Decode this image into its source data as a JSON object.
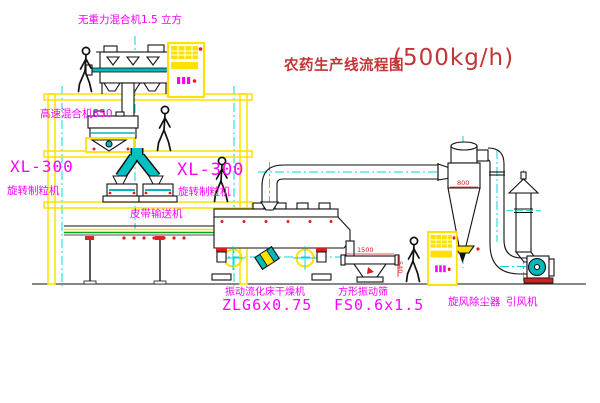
{
  "title": {
    "text": "农药生产线流程图",
    "capacity": "(500kg/h)"
  },
  "labels": {
    "gravity_mixer": "无重力混合机1.5 立方",
    "high_speed_mixer": "高速混合机350",
    "granulator_left_model": "XL-300",
    "granulator_left_name": "旋转制粒机",
    "granulator_right_model": "XL-300",
    "granulator_right_name": "旋转制粒机",
    "belt_conveyor": "皮带输送机",
    "dryer_name": "振动流化床干燥机",
    "dryer_model": "ZLG6x0.75",
    "sieve_name": "方形振动筛",
    "sieve_model": "FS0.6x1.5",
    "cyclone": "旋风除尘器",
    "fan": "引风机"
  },
  "dimensions": {
    "cyclone_width": "800",
    "sieve_length": "1500",
    "sieve_height": "540"
  },
  "colors": {
    "structure_yellow": "#ffe100",
    "centerline_cyan": "#00d8d8",
    "label_magenta": "#ff00ff",
    "title_red": "#c23535",
    "dimension_red": "#d42020",
    "equipment_black": "#111111",
    "belt_green": "#00a814",
    "machine_teal": "#00b8b8"
  }
}
